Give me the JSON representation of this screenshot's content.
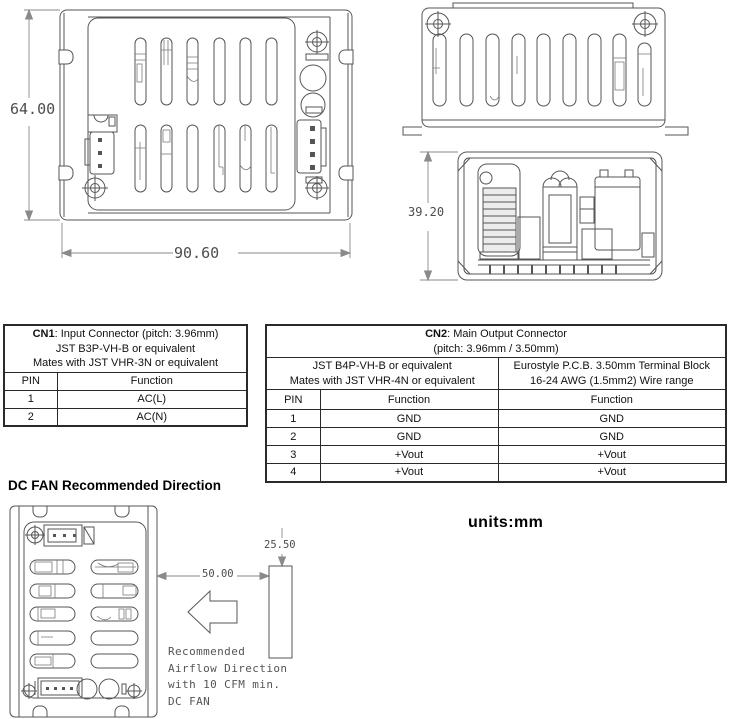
{
  "page": {
    "units_label": "units:mm"
  },
  "drawings": {
    "top_view": {
      "dim_height": "64.00",
      "dim_width": "90.60"
    },
    "side_view": {
      "dim_height": "39.20"
    },
    "fan_view": {
      "title": "DC FAN Recommended Direction",
      "dim_distance": "50.00",
      "dim_fan": "25.50",
      "note_lines": [
        "Recommended",
        "Airflow Direction",
        "with 10 CFM min.",
        "DC FAN"
      ]
    }
  },
  "cn1_table": {
    "title_bold": "CN1",
    "title_rest": ": Input Connector  (pitch: 3.96mm)",
    "subtitle1": "JST B3P-VH-B or equivalent",
    "subtitle2": "Mates with JST VHR-3N or equivalent",
    "col_pin": "PIN",
    "col_function": "Function",
    "rows": [
      {
        "pin": "1",
        "function": "AC(L)"
      },
      {
        "pin": "2",
        "function": "AC(N)"
      }
    ]
  },
  "cn2_table": {
    "title_bold": "CN2",
    "title_rest": ": Main Output Connector",
    "title_line2": "(pitch: 3.96mm / 3.50mm)",
    "jst_header1": "JST B4P-VH-B or equivalent",
    "jst_header2": "Mates with JST VHR-4N or equivalent",
    "euro_header1": "Eurostyle P.C.B. 3.50mm Terminal Block",
    "euro_header2": "16-24 AWG (1.5mm2) Wire range",
    "col_pin": "PIN",
    "col_function1": "Function",
    "col_function2": "Function",
    "rows": [
      {
        "pin": "1",
        "f1": "GND",
        "f2": "GND"
      },
      {
        "pin": "2",
        "f1": "GND",
        "f2": "GND"
      },
      {
        "pin": "3",
        "f1": "+Vout",
        "f2": "+Vout"
      },
      {
        "pin": "4",
        "f1": "+Vout",
        "f2": "+Vout"
      }
    ]
  }
}
